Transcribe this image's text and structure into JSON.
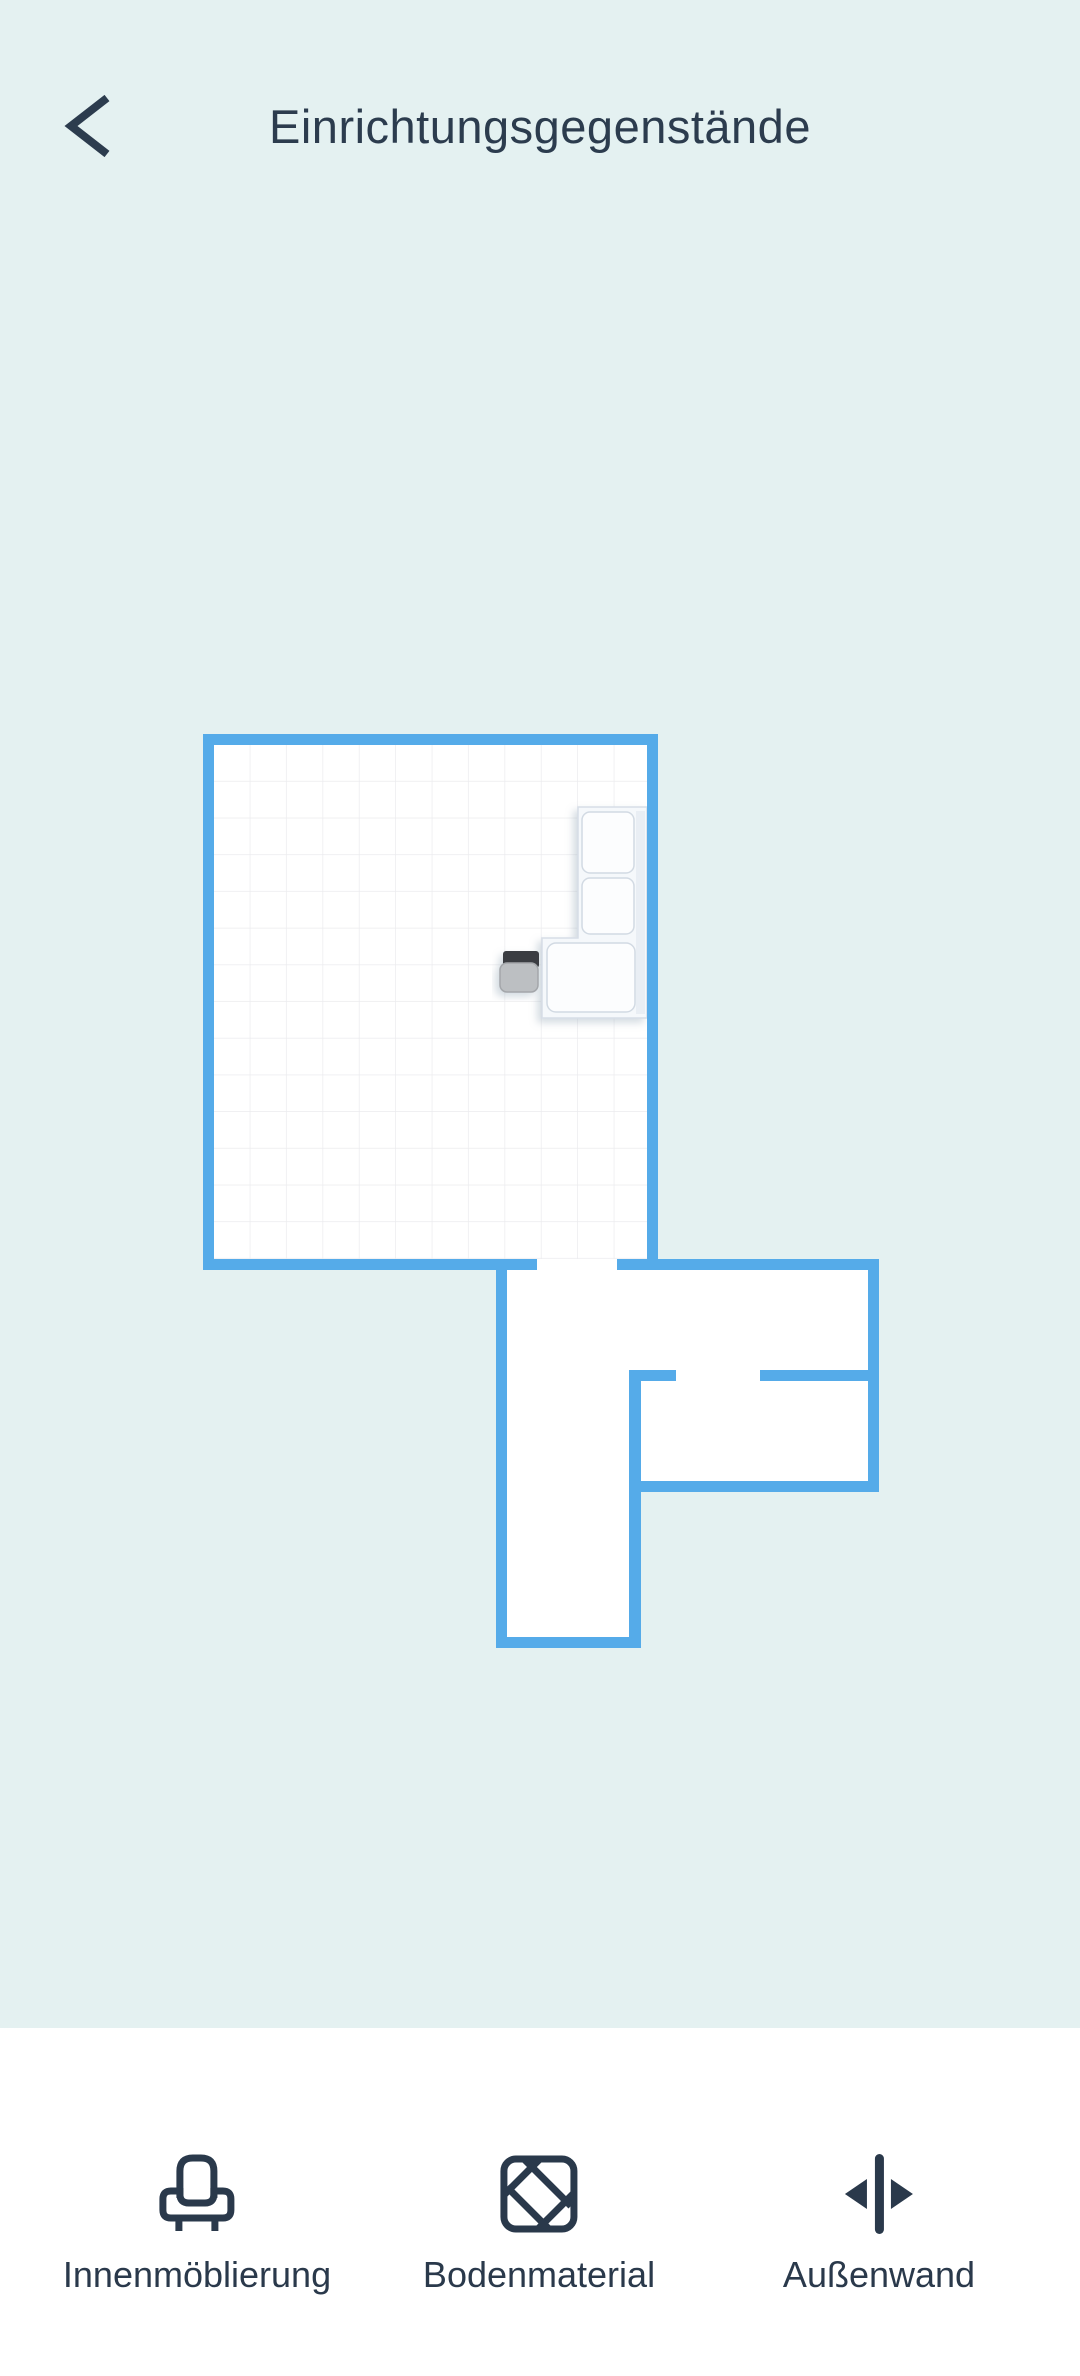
{
  "header": {
    "title": "Einrichtungsgegenstände"
  },
  "floorplan": {
    "wall_color": "#55abe9",
    "floor_color": "#ffffff",
    "grid_color": "#ebebee",
    "background_color": "#e4f1f1",
    "furniture": [
      {
        "name": "corner-sofa",
        "body_color": "#f5f8fb"
      },
      {
        "name": "small-chair",
        "seat_color": "#bcbfc2",
        "back_color": "#3a3e42"
      }
    ]
  },
  "tabbar": {
    "background": "#ffffff",
    "items": [
      {
        "label": "Innenmöblierung",
        "icon": "armchair-icon"
      },
      {
        "label": "Bodenmaterial",
        "icon": "floor-tiles-icon"
      },
      {
        "label": "Außenwand",
        "icon": "wall-width-icon"
      }
    ]
  }
}
